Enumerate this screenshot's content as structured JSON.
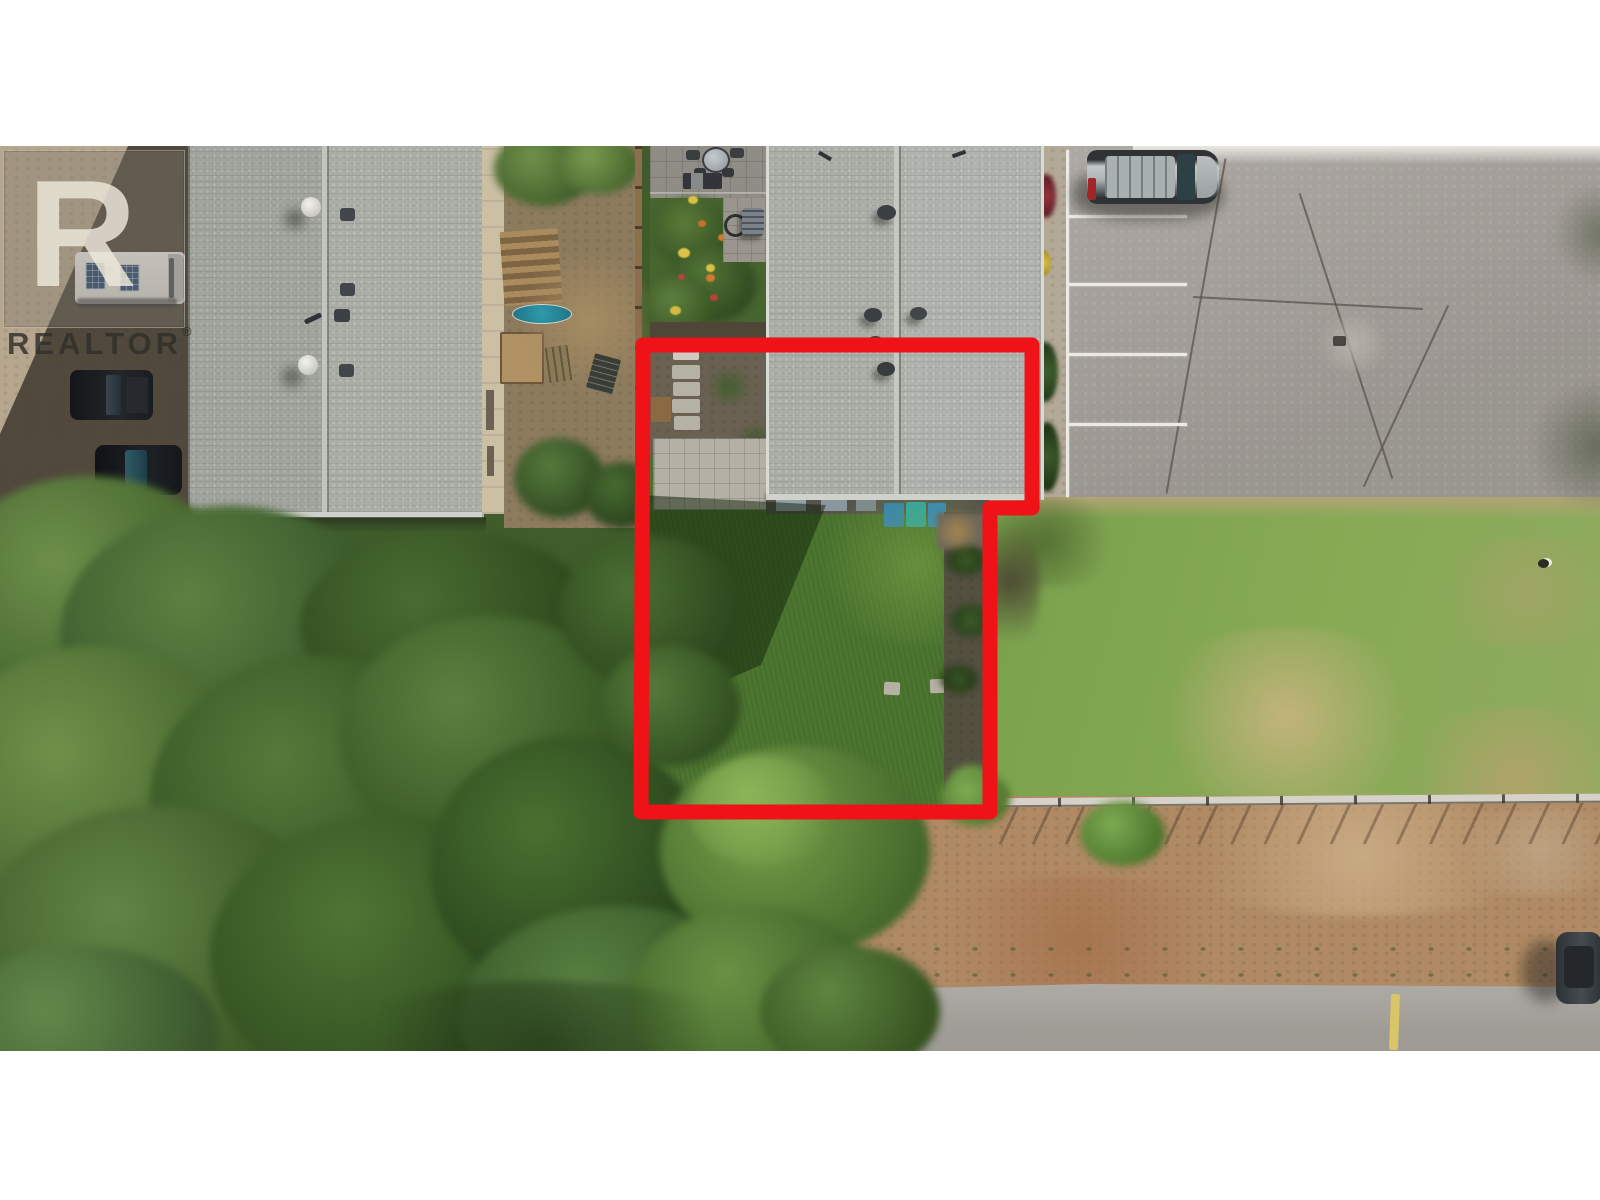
{
  "image": {
    "kind": "aerial-drone-photo",
    "description": "Overhead aerial view of a residential lot outlined in red, between townhouse roofs, a parking lot, a vacant grass lot, tree canopy, dirt field and a road",
    "letterbox_color": "#ffffff"
  },
  "watermark": {
    "brand_text": "REALTOR",
    "registered_mark": "®",
    "logo_letter": "R"
  },
  "overlay": {
    "boundary_color": "#ef1217",
    "boundary_stroke_px": 15
  },
  "scene": {
    "object_labels": [
      "left-building-roof",
      "subject-building-roof",
      "roof-vents",
      "backyard-garden",
      "flower-garden",
      "patio-table",
      "parking-lot",
      "parking-stall-lines",
      "silver-suv",
      "rv-camper",
      "black-pickup",
      "dark-suv",
      "vacant-grass-lot",
      "tree-canopy",
      "dirt-field",
      "road",
      "yellow-curb-mark",
      "parked-car",
      "fence-line",
      "recycling-bins",
      "concrete-patio",
      "gravel-path"
    ],
    "colors": {
      "roof_gray": "#a8aca5",
      "lawn_green": "#7da14d",
      "tree_green": "#4e7234",
      "asphalt_gray": "#a49f99",
      "dirt_brown": "#b28a63",
      "road_gray": "#a7a39d",
      "bin_blue": "#2e86c4",
      "bin_teal": "#2aa8ae",
      "curb_yellow": "#d9c468"
    }
  }
}
